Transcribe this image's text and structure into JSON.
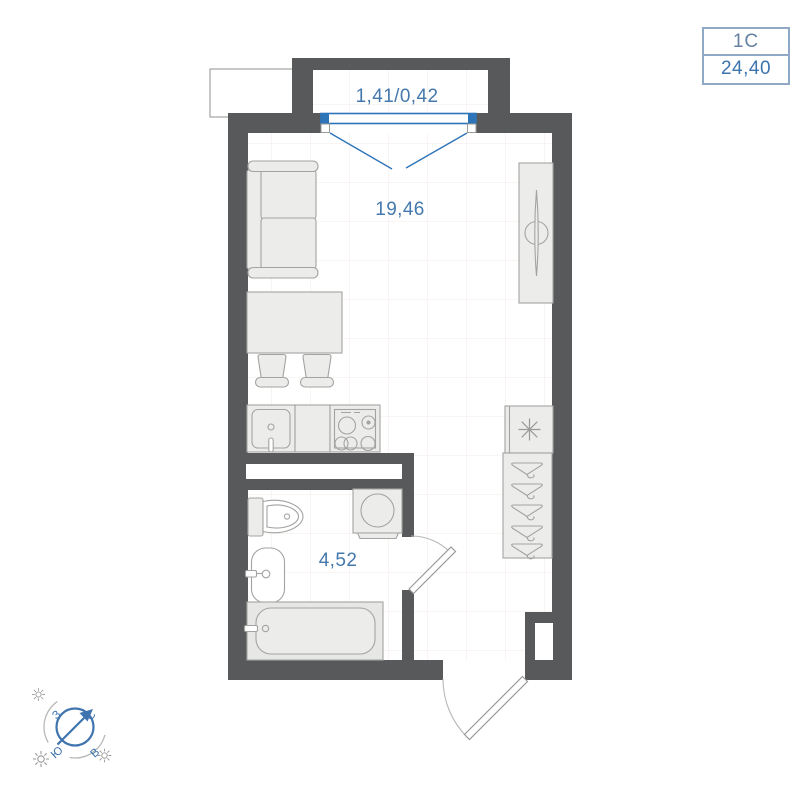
{
  "badge": {
    "type": "1С",
    "total_area": "24,40"
  },
  "rooms": {
    "living_kitchen": {
      "area": "19,46"
    },
    "bathroom": {
      "area": "4,52"
    },
    "balcony": {
      "area": "1,41/0,42"
    }
  },
  "compass": {
    "north": "С",
    "south": "Ю",
    "west": "З",
    "east": "В"
  },
  "colors": {
    "wall": "#58595b",
    "window_blue": "#2d74b8",
    "label_blue": "#4579ad",
    "badge_border": "#8fa9c6",
    "furniture_fill": "#ececea",
    "furniture_stroke": "#a3a3a1",
    "grid_line": "#f3efec",
    "compass_blue": "#3f74ae"
  },
  "icons": {
    "furniture": [
      "sofa",
      "dining-table",
      "chair",
      "kitchen-sink",
      "stove",
      "wardrobe",
      "refrigerator",
      "hanger-closet",
      "toilet",
      "washing-machine",
      "bathroom-sink",
      "bathtub"
    ],
    "symbols": [
      "compass-icon",
      "sun-icon",
      "snowflake-icon",
      "hanger-icon"
    ]
  }
}
